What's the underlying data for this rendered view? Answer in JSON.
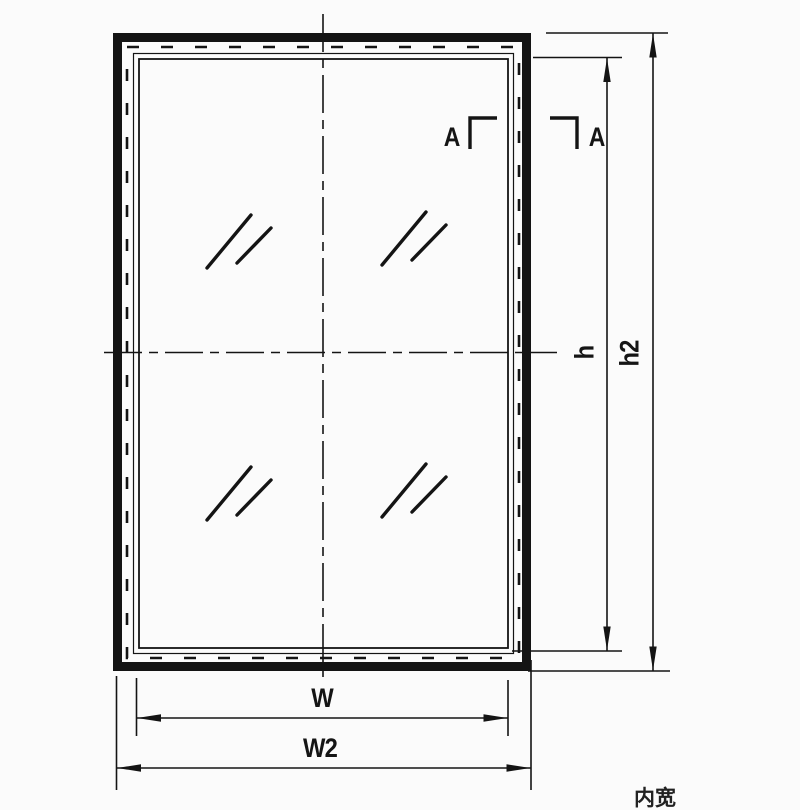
{
  "drawing": {
    "type": "technical-window-frame-elevation",
    "labels": {
      "width_inner": "W",
      "width_outer": "W2",
      "height_inner": "h",
      "height_outer": "h2",
      "section_left": "A",
      "section_right": "A",
      "corner_note_partial": "内宽"
    },
    "glass_marks_count": 4,
    "colors": {
      "line": "#141414",
      "background": "#fbfbfb"
    }
  }
}
